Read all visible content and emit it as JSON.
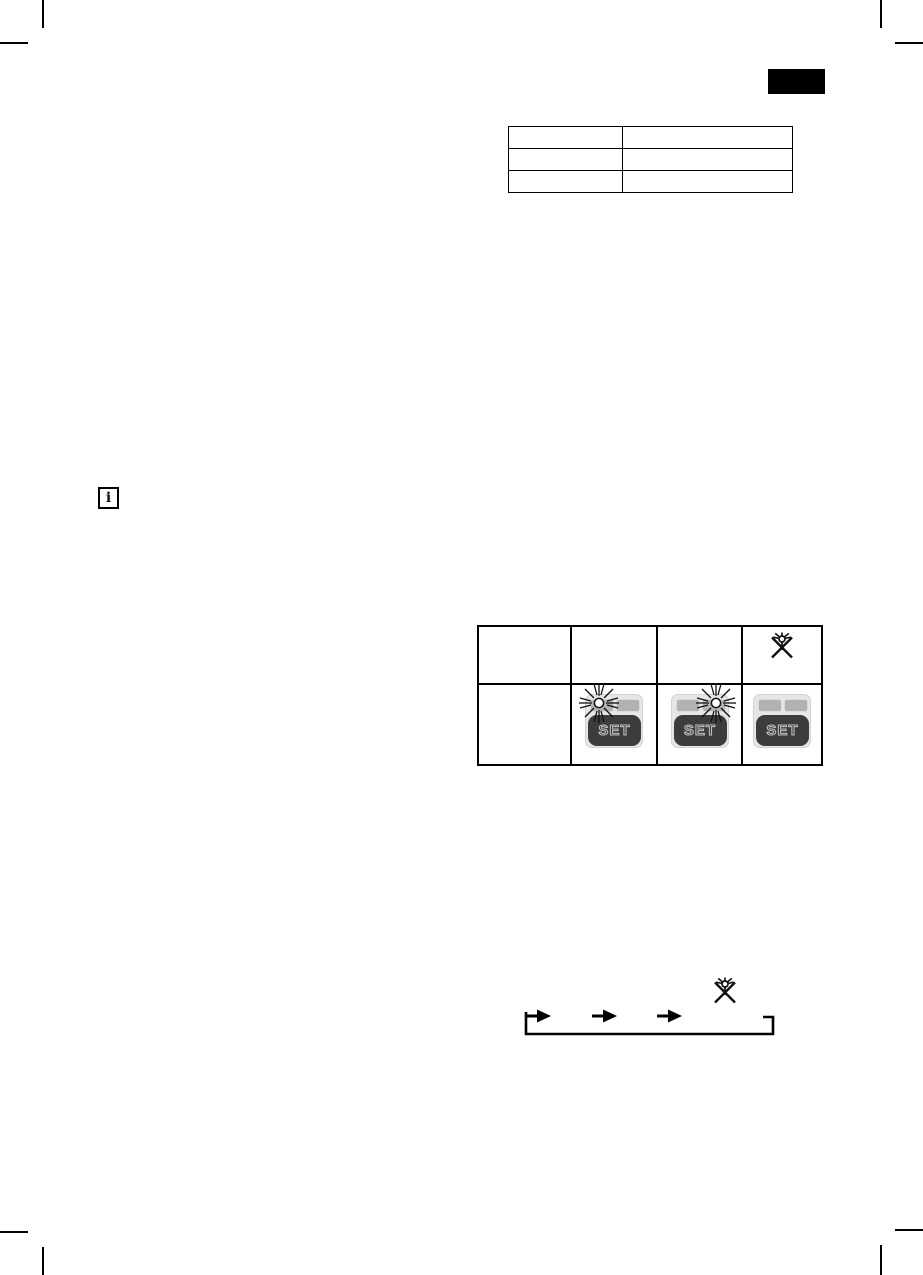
{
  "colors": {
    "ink": "#000000",
    "page_bg": "#ffffff",
    "panel_bg": "#e6e6e6",
    "indicator_fill": "#b2b2b2",
    "set_button_fill": "#3c3c3c",
    "set_text_outline": "#c4c4c4"
  },
  "language_tab": {
    "icon": "black-tab-marker"
  },
  "spec_table": {
    "columns": 2,
    "rows": [
      [
        "",
        ""
      ],
      [
        "",
        ""
      ],
      [
        "",
        ""
      ]
    ]
  },
  "info_note": {
    "icon": "info-icon",
    "label": "i"
  },
  "set_table": {
    "set_label": "SET",
    "header_row": [
      "",
      "",
      "",
      "led-blinking-crossed-icon"
    ],
    "button_row": [
      "",
      "set-panel-led-left-blinking",
      "set-panel-led-right-blinking",
      "set-panel-leds-off"
    ]
  },
  "cycle_diagram": {
    "arrow_icons": [
      "arrow-right-icon",
      "arrow-right-icon",
      "arrow-right-icon"
    ],
    "end_icon": "led-blinking-crossed-icon",
    "loop_back": true
  }
}
